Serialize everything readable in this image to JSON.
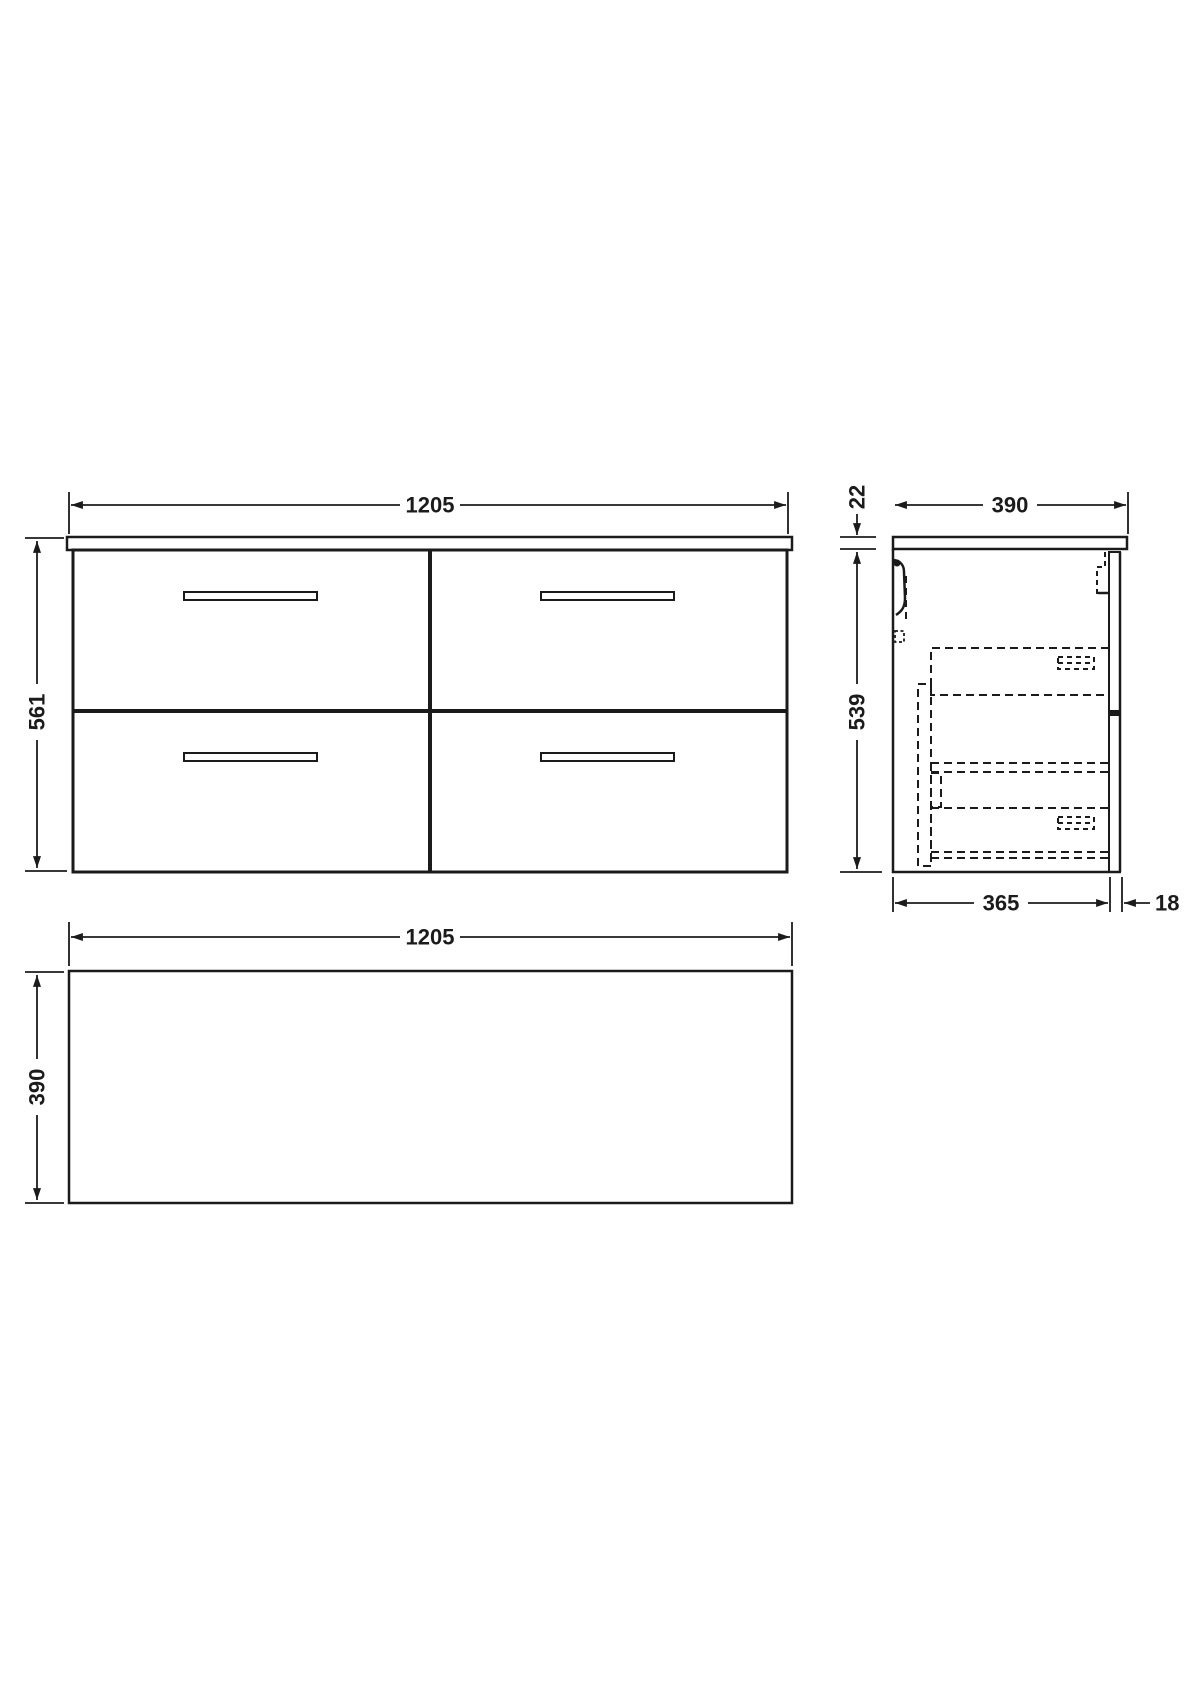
{
  "drawing": {
    "type": "technical-dimension-drawing",
    "subject": "wall-hung four-drawer vanity cabinet (front, side and plan views)",
    "colors": {
      "line": "#1b1b1b",
      "background": "#ffffff"
    },
    "front_view": {
      "width_label": "1205",
      "height_label": "561",
      "drawers": 4,
      "handles": 4
    },
    "side_view": {
      "worktop_thickness_label": "22",
      "depth_label": "390",
      "height_label": "539",
      "internal_depth_label": "365",
      "back_panel_label": "18"
    },
    "plan_view": {
      "width_label": "1205",
      "depth_label": "390"
    }
  }
}
